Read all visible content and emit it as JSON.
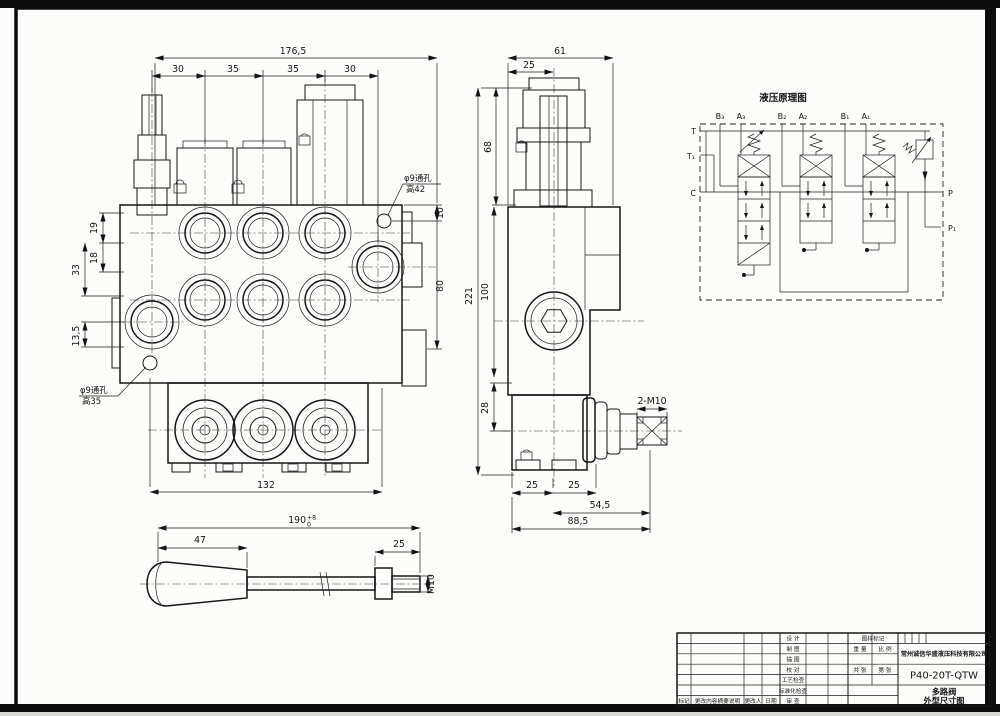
{
  "front": {
    "total": "176,5",
    "seg1": "30",
    "seg2": "35",
    "seg3": "35",
    "seg4": "30",
    "left19": "19",
    "left18": "18",
    "left33": "33",
    "left135": "13,5",
    "right10": "10",
    "right80": "80",
    "bottom132": "132",
    "holeTop1": "φ9通孔",
    "holeTop2": "高42",
    "holeBot1": "φ9通孔",
    "holeBot2": "高35"
  },
  "side": {
    "w61": "61",
    "w25": "25",
    "h68": "68",
    "h221": "221",
    "h100": "100",
    "h28": "28",
    "b25a": "25",
    "b25b": "25",
    "b545": "54,5",
    "b885": "88,5",
    "joint": "2-M10"
  },
  "lever": {
    "total": "190",
    "tolUp": "+8",
    "tolDn": "0",
    "grip": "47",
    "thread25": "25",
    "m10": "M10"
  },
  "schem": {
    "title": "液压原理图",
    "b3": "B₃",
    "a3": "A₃",
    "b2": "B₂",
    "a2": "A₂",
    "b1": "B₁",
    "a1": "A₁",
    "t": "T",
    "t1": "T₁",
    "c": "C",
    "p": "P",
    "p1": "P₁"
  },
  "tb": {
    "design": "设 计",
    "draft": "制 图",
    "trace": "描 图",
    "check": "校 对",
    "process": "工艺检查",
    "standard": "标准化检查",
    "review": "审 查",
    "mark": "标记",
    "changeDesc": "更改内容摘要说明",
    "changer": "更改人",
    "date": "日期",
    "drawMark": "图样标记",
    "weight": "重 量",
    "scale": "比 例",
    "sheets": "共 张",
    "page": "第 张",
    "company": "常州诚信华盛液压科技有限公司",
    "model": "P40-20T-QTW",
    "name1": "多路阀",
    "name2": "外型尺寸图"
  }
}
